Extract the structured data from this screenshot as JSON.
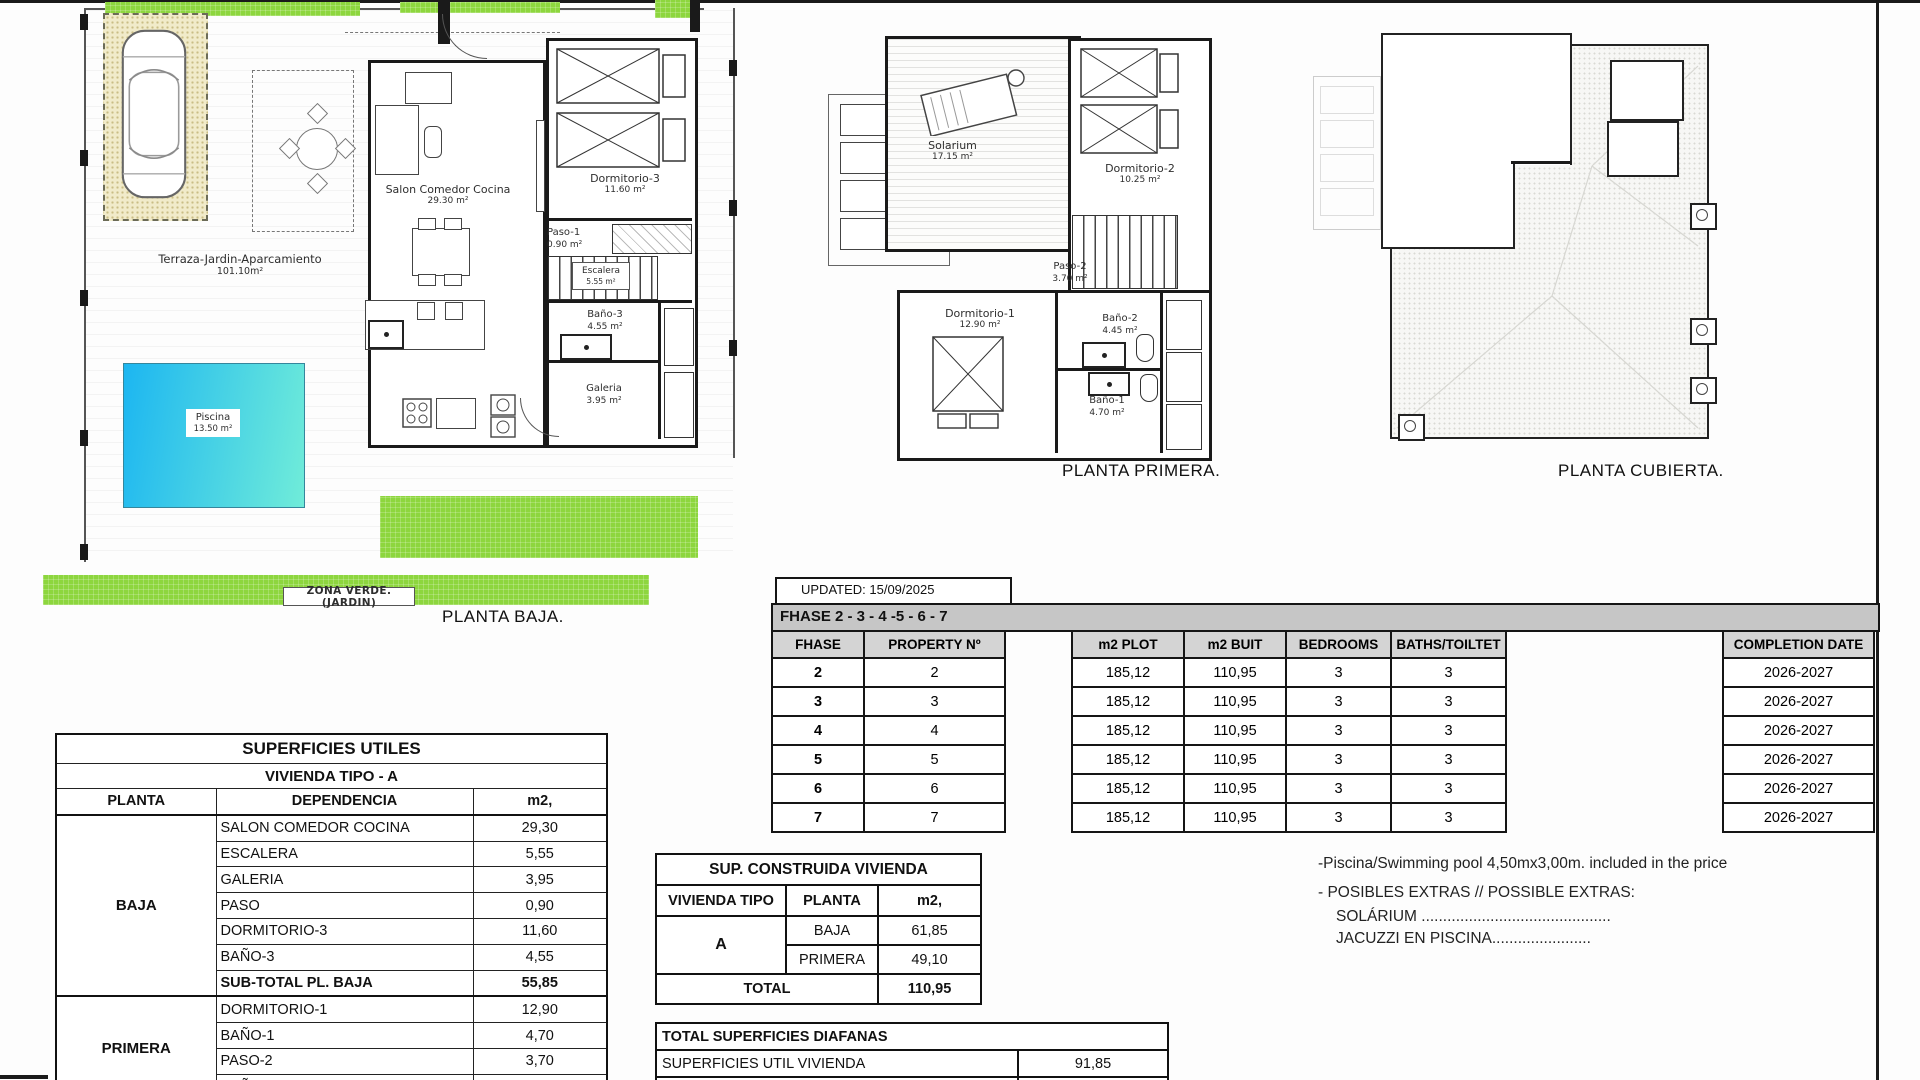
{
  "plans": {
    "baja": {
      "title": "PLANTA BAJA.",
      "zona_verde": "ZONA  VERDE. (JARDIN)",
      "terraza": {
        "name": "Terraza-Jardin-Aparcamiento",
        "area": "101.10m²"
      },
      "piscina": {
        "name": "Piscina",
        "area": "13.50 m²"
      },
      "salon": {
        "name": "Salon  Comedor  Cocina",
        "area": "29.30 m²"
      },
      "dormitorio3": {
        "name": "Dormitorio-3",
        "area": "11.60 m²"
      },
      "paso1": {
        "name": "Paso-1",
        "area": "0.90 m²"
      },
      "escalera": {
        "name": "Escalera",
        "area": "5.55 m²"
      },
      "bano3": {
        "name": "Baño-3",
        "area": "4.55 m²"
      },
      "galeria": {
        "name": "Galeria",
        "area": "3.95 m²"
      }
    },
    "primera": {
      "title": "PLANTA PRIMERA.",
      "solarium": {
        "name": "Solarium",
        "area": "17.15 m²"
      },
      "dormitorio2": {
        "name": "Dormitorio-2",
        "area": "10.25 m²"
      },
      "paso2": {
        "name": "Paso-2",
        "area": "3.70 m²"
      },
      "dormitorio1": {
        "name": "Dormitorio-1",
        "area": "12.90 m²"
      },
      "bano2": {
        "name": "Baño-2",
        "area": "4.45 m²"
      },
      "bano1": {
        "name": "Baño-1",
        "area": "4.70 m²"
      }
    },
    "cubierta": {
      "title": "PLANTA CUBIERTA."
    }
  },
  "phase_table": {
    "updated": "UPDATED: 15/09/2025",
    "band": "FHASE  2 - 3 - 4 -5 - 6 - 7",
    "headers": {
      "fhase": "FHASE",
      "property": "PROPERTY Nº",
      "plot": "m2 PLOT",
      "built": "m2 BUIT",
      "bedrooms": "BEDROOMS",
      "baths": "BATHS/TOILTET",
      "completion": "COMPLETION DATE"
    },
    "rows": [
      {
        "fhase": "2",
        "property": "2",
        "plot": "185,12",
        "built": "110,95",
        "bedrooms": "3",
        "baths": "3",
        "completion": "2026-2027"
      },
      {
        "fhase": "3",
        "property": "3",
        "plot": "185,12",
        "built": "110,95",
        "bedrooms": "3",
        "baths": "3",
        "completion": "2026-2027"
      },
      {
        "fhase": "4",
        "property": "4",
        "plot": "185,12",
        "built": "110,95",
        "bedrooms": "3",
        "baths": "3",
        "completion": "2026-2027"
      },
      {
        "fhase": "5",
        "property": "5",
        "plot": "185,12",
        "built": "110,95",
        "bedrooms": "3",
        "baths": "3",
        "completion": "2026-2027"
      },
      {
        "fhase": "6",
        "property": "6",
        "plot": "185,12",
        "built": "110,95",
        "bedrooms": "3",
        "baths": "3",
        "completion": "2026-2027"
      },
      {
        "fhase": "7",
        "property": "7",
        "plot": "185,12",
        "built": "110,95",
        "bedrooms": "3",
        "baths": "3",
        "completion": "2026-2027"
      }
    ]
  },
  "superficies_utiles": {
    "title": "SUPERFICIES UTILES",
    "subtitle": "VIVIENDA TIPO - A",
    "col_planta": "PLANTA",
    "col_dependencia": "DEPENDENCIA",
    "col_m2": "m2,",
    "baja_label": "BAJA",
    "primera_label": "PRIMERA",
    "rows_baja": [
      [
        "SALON COMEDOR COCINA",
        "29,30"
      ],
      [
        "ESCALERA",
        "5,55"
      ],
      [
        "GALERIA",
        "3,95"
      ],
      [
        "PASO",
        "0,90"
      ],
      [
        "DORMITORIO-3",
        "11,60"
      ],
      [
        "BAÑO-3",
        "4,55"
      ]
    ],
    "subtotal_label": "SUB-TOTAL PL. BAJA",
    "subtotal_value": "55,85",
    "rows_primera": [
      [
        "DORMITORIO-1",
        "12,90"
      ],
      [
        "BAÑO-1",
        "4,70"
      ],
      [
        "PASO-2",
        "3,70"
      ],
      [
        "BAÑO-2",
        "4,45"
      ]
    ]
  },
  "sup_construida": {
    "title": "SUP. CONSTRUIDA VIVIENDA",
    "col_tipo": "VIVIENDA TIPO",
    "col_planta": "PLANTA",
    "col_m2": "m2,",
    "tipo": "A",
    "row_baja_label": "BAJA",
    "row_baja_value": "61,85",
    "row_primera_label": "PRIMERA",
    "row_primera_value": "49,10",
    "total_label": "TOTAL",
    "total_value": "110,95"
  },
  "diafanas": {
    "title": "TOTAL SUPERFICIES DIAFANAS",
    "row1_label": "SUPERFICIES UTIL VIVIENDA",
    "row1_value": "91,85",
    "row2_label": "SOLARIUM PL. PRIMERA",
    "row2_value": "17,15"
  },
  "notes": {
    "line1": "-Piscina/Swimming pool 4,50mx3,00m. included in the price",
    "line2": "- POSIBLES EXTRAS // POSSIBLE EXTRAS:",
    "line3": "SOLÁRIUM ............................................",
    "line4": "JACUZZI EN PISCINA......................."
  },
  "colors": {
    "green": "#8dd63e",
    "pool_start": "#1cb6f1",
    "pool_end": "#70ecd9",
    "band_gray": "#c6c6c6",
    "header_gray": "#d4d4d4"
  }
}
